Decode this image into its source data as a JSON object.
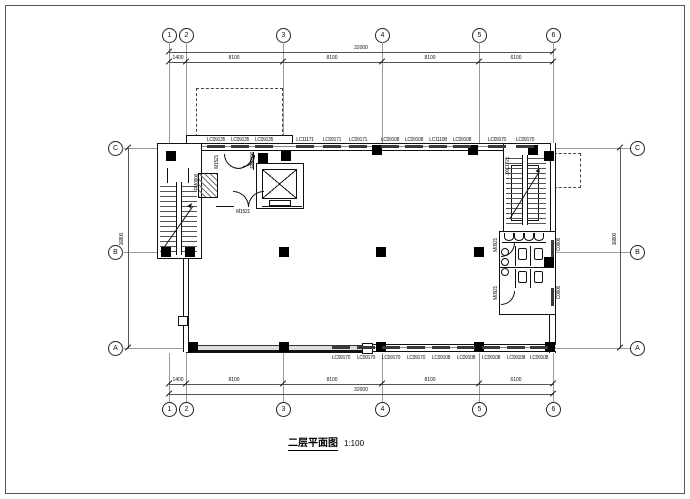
{
  "title": {
    "name": "二层平面图",
    "scale": "1:100"
  },
  "grid": {
    "columns": [
      "1",
      "2",
      "3",
      "4",
      "5",
      "6"
    ],
    "rows": [
      "C",
      "B",
      "A"
    ]
  },
  "dimensions": {
    "total_width": "32000",
    "segments": [
      "1400",
      "8100",
      "8100",
      "8100",
      "6100"
    ],
    "total_height": "16800"
  },
  "windows_top": [
    "LC09135",
    "LC09135",
    "LC09135",
    "LC11171",
    "LC09171",
    "LC09171",
    "LC09108",
    "LC09108",
    "LC11108",
    "LC09108",
    "LC09170",
    "LC09170"
  ],
  "windows_bottom": [
    "LC09170",
    "LC09170",
    "LC09170",
    "LC09170",
    "LC09108",
    "LC09108",
    "LC09108",
    "LC09108",
    "LC09108"
  ],
  "labels": {
    "door_m1521": "M1521",
    "door_fm0906": "FM0906",
    "door_m0921": "M0921",
    "window_c0906": "C0906",
    "door_jxc1721": "JXC1721"
  },
  "colors": {
    "line": "#111111",
    "grid_line": "#999999",
    "dim_line": "#555555",
    "window_bar": "#3a3a3a"
  }
}
